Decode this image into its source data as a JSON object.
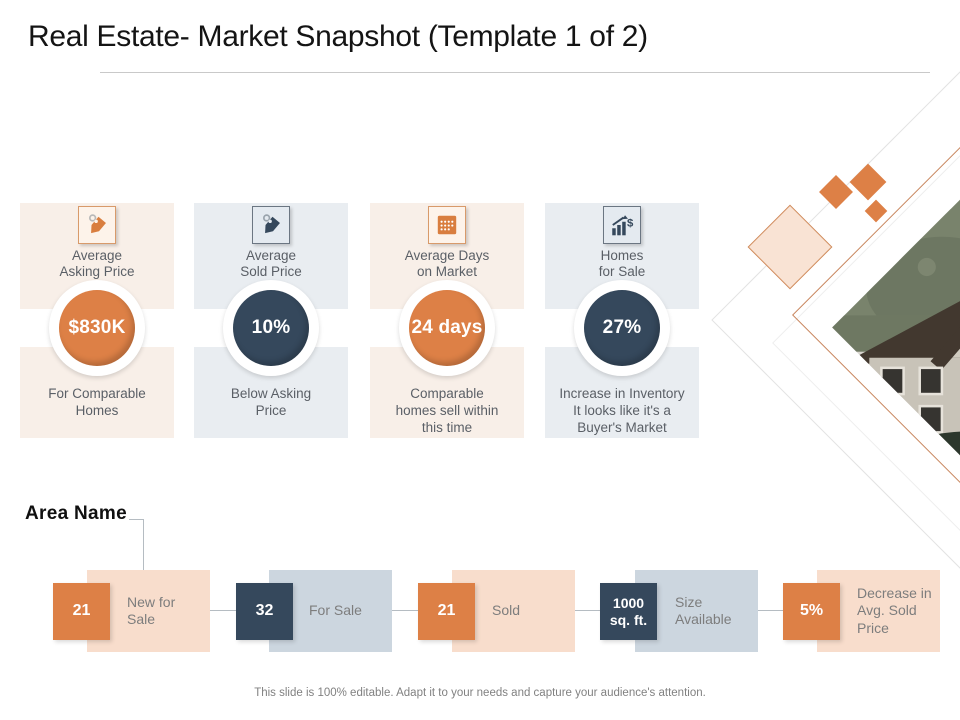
{
  "title": "Real Estate- Market Snapshot (Template 1 of 2)",
  "cards": [
    {
      "icon": "price-tag-icon",
      "label": "Average\nAsking Price",
      "value": "$830K",
      "description": "For Comparable\nHomes",
      "theme": "orange"
    },
    {
      "icon": "price-tag-icon",
      "label": "Average\nSold Price",
      "value": "10%",
      "description": "Below Asking\nPrice",
      "theme": "navy"
    },
    {
      "icon": "calendar-icon",
      "label": "Average  Days\non Market",
      "value": "24 days",
      "description": "Comparable\nhomes sell within\nthis time",
      "theme": "orange"
    },
    {
      "icon": "growth-chart-icon",
      "label": "Homes\nfor Sale",
      "value": "27%",
      "description": "Increase in Inventory\nIt looks like it's a\nBuyer's Market",
      "theme": "navy"
    }
  ],
  "area": {
    "label": "Area Name",
    "stats": [
      {
        "value": "21",
        "label": "New for\nSale",
        "theme": "orange"
      },
      {
        "value": "32",
        "label": "For Sale",
        "theme": "navy"
      },
      {
        "value": "21",
        "label": "Sold",
        "theme": "orange"
      },
      {
        "value": "1000\nsq. ft.",
        "label": "Size\nAvailable",
        "theme": "navy"
      },
      {
        "value": "5%",
        "label": "Decrease in\nAvg. Sold\nPrice",
        "theme": "orange"
      }
    ]
  },
  "footer": "This slide is 100% editable. Adapt it to your needs and capture your audience's attention.",
  "colors": {
    "orange": "#dd8046",
    "navy": "#35485c",
    "card_peach_bg": "#f8efe8",
    "card_blue_bg": "#e9edf1",
    "block_peach": "#f8ddcc",
    "block_blue": "#ccd6df",
    "text_gray": "#5a5f66",
    "line_gray": "#b5bcc2"
  }
}
